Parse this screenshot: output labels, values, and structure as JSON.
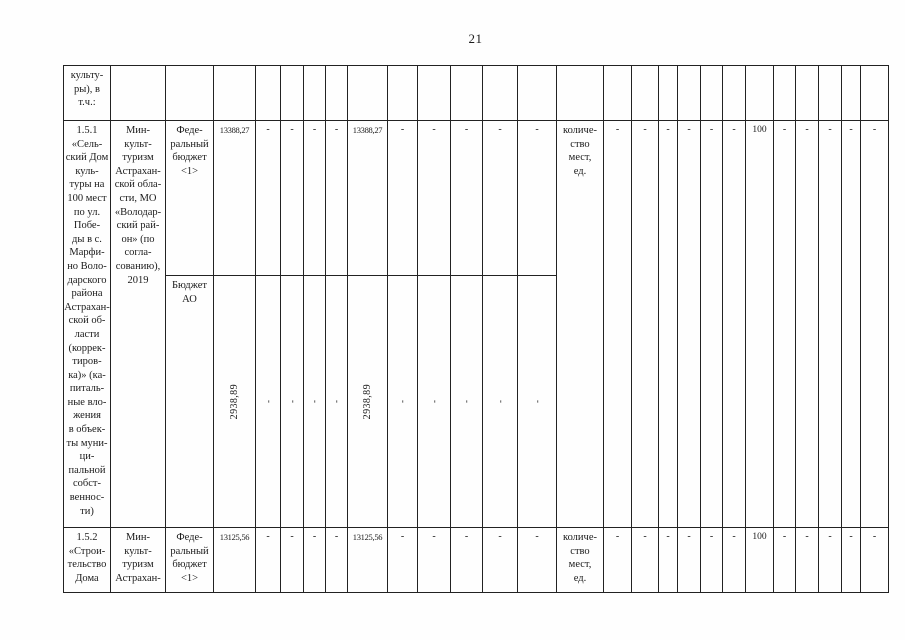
{
  "page_number": "21",
  "table": {
    "cells": [
      {
        "r": 1,
        "c": 1,
        "t": "культу-\nры), в\nт.ч.:",
        "n": "cell-continued-category"
      },
      {
        "r": 2,
        "c": 1,
        "rs": 2,
        "t": "1.5.1\n«Сель-\nский Дом\nкуль-\nтуры на\n100 мест\nпо ул.\nПобе-\nды в с.\nМарфи-\nно Воло-\nдарского\nрайона\nАстрахан-\nской об-\nласти\n(коррек-\nтиров-\nка)» (ка-\nпиталь-\nные вло-\nжения\nв объек-\nты муни-\nци-\nпальной\nсобст-\nвеннос-\nти)",
        "n": "cell-project-1-5-1-name"
      },
      {
        "r": 2,
        "c": 2,
        "rs": 2,
        "t": "Мин-\nкульт-\nтуризм\nАстрахан-\nской обла-\nсти, МО\n«Володар-\nский рай-\nон» (по\nсогла-\nсованию),\n2019",
        "n": "cell-project-1-5-1-executor"
      },
      {
        "r": 2,
        "c": 3,
        "t": "Феде-\nральный\nбюджет\n<1>",
        "n": "cell-budget-federal-1-5-1"
      },
      {
        "r": 2,
        "c": 4,
        "k": "num",
        "t": "13388,27",
        "n": "cell-amount-total-federal"
      },
      {
        "r": 2,
        "c": 5,
        "k": "dash",
        "t": "-",
        "n": "cell-amount-dash"
      },
      {
        "r": 2,
        "c": 6,
        "k": "dash",
        "t": "-",
        "n": "cell-amount-dash"
      },
      {
        "r": 2,
        "c": 7,
        "k": "dash",
        "t": "-",
        "n": "cell-amount-dash"
      },
      {
        "r": 2,
        "c": 8,
        "k": "dash",
        "t": "-",
        "n": "cell-amount-dash"
      },
      {
        "r": 2,
        "c": 9,
        "k": "num",
        "t": "13388,27",
        "n": "cell-amount-year-federal"
      },
      {
        "r": 2,
        "c": 10,
        "k": "dash",
        "t": "-",
        "n": "cell-amount-dash"
      },
      {
        "r": 2,
        "c": 11,
        "k": "dash",
        "t": "-",
        "n": "cell-amount-dash"
      },
      {
        "r": 2,
        "c": 12,
        "k": "dash",
        "t": "-",
        "n": "cell-amount-dash"
      },
      {
        "r": 2,
        "c": 13,
        "k": "dash",
        "t": "-",
        "n": "cell-amount-dash"
      },
      {
        "r": 2,
        "c": 14,
        "k": "dash",
        "t": "-",
        "n": "cell-amount-dash"
      },
      {
        "r": 3,
        "c": 3,
        "t": "Бюджет\nАО",
        "n": "cell-budget-regional-1-5-1"
      },
      {
        "r": 3,
        "c": 4,
        "k": "rot num",
        "t": "2938,89",
        "n": "cell-amount-total-regional"
      },
      {
        "r": 3,
        "c": 5,
        "k": "rot dash",
        "t": "-",
        "n": "cell-amount-dash"
      },
      {
        "r": 3,
        "c": 6,
        "k": "rot dash",
        "t": "-",
        "n": "cell-amount-dash"
      },
      {
        "r": 3,
        "c": 7,
        "k": "rot dash",
        "t": "-",
        "n": "cell-amount-dash"
      },
      {
        "r": 3,
        "c": 8,
        "k": "rot dash",
        "t": "-",
        "n": "cell-amount-dash"
      },
      {
        "r": 3,
        "c": 9,
        "k": "rot num",
        "t": "2938,89",
        "n": "cell-amount-year-regional"
      },
      {
        "r": 3,
        "c": 10,
        "k": "rot dash",
        "t": "-",
        "n": "cell-amount-dash"
      },
      {
        "r": 3,
        "c": 11,
        "k": "rot dash",
        "t": "-",
        "n": "cell-amount-dash"
      },
      {
        "r": 3,
        "c": 12,
        "k": "rot dash",
        "t": "-",
        "n": "cell-amount-dash"
      },
      {
        "r": 3,
        "c": 13,
        "k": "rot dash",
        "t": "-",
        "n": "cell-amount-dash"
      },
      {
        "r": 3,
        "c": 14,
        "k": "rot dash",
        "t": "-",
        "n": "cell-amount-dash"
      },
      {
        "r": 2,
        "c": 15,
        "rs": 2,
        "t": "количе-\nство\nмест,\nед.",
        "n": "cell-indicator-name-1-5-1"
      },
      {
        "r": 2,
        "c": 16,
        "rs": 2,
        "k": "dash",
        "t": "-",
        "n": "cell-indicator-dash"
      },
      {
        "r": 2,
        "c": 17,
        "rs": 2,
        "k": "dash",
        "t": "-",
        "n": "cell-indicator-dash"
      },
      {
        "r": 2,
        "c": 18,
        "rs": 2,
        "k": "dash",
        "t": "-",
        "n": "cell-indicator-dash"
      },
      {
        "r": 2,
        "c": 19,
        "rs": 2,
        "k": "dash",
        "t": "-",
        "n": "cell-indicator-dash"
      },
      {
        "r": 2,
        "c": 20,
        "rs": 2,
        "k": "dash",
        "t": "-",
        "n": "cell-indicator-dash"
      },
      {
        "r": 2,
        "c": 21,
        "rs": 2,
        "k": "dash",
        "t": "-",
        "n": "cell-indicator-dash"
      },
      {
        "r": 2,
        "c": 22,
        "rs": 2,
        "k": "val",
        "t": "100",
        "n": "cell-indicator-value-1-5-1"
      },
      {
        "r": 2,
        "c": 23,
        "rs": 2,
        "k": "dash",
        "t": "-",
        "n": "cell-indicator-dash"
      },
      {
        "r": 2,
        "c": 24,
        "rs": 2,
        "k": "dash",
        "t": "-",
        "n": "cell-indicator-dash"
      },
      {
        "r": 2,
        "c": 25,
        "rs": 2,
        "k": "dash",
        "t": "-",
        "n": "cell-indicator-dash"
      },
      {
        "r": 2,
        "c": 26,
        "rs": 2,
        "k": "dash",
        "t": "-",
        "n": "cell-indicator-dash"
      },
      {
        "r": 2,
        "c": 27,
        "rs": 2,
        "k": "dash",
        "t": "-",
        "n": "cell-indicator-dash"
      },
      {
        "r": 4,
        "c": 1,
        "t": "1.5.2\n«Строи-\nтельство\nДома",
        "n": "cell-project-1-5-2-name"
      },
      {
        "r": 4,
        "c": 2,
        "t": "Мин-\nкульт-\nтуризм\nАстрахан-",
        "n": "cell-project-1-5-2-executor"
      },
      {
        "r": 4,
        "c": 3,
        "t": "Феде-\nральный\nбюджет\n<1>",
        "n": "cell-budget-federal-1-5-2"
      },
      {
        "r": 4,
        "c": 4,
        "k": "num",
        "t": "13125,56",
        "n": "cell-amount-total-federal"
      },
      {
        "r": 4,
        "c": 5,
        "k": "dash",
        "t": "-",
        "n": "cell-amount-dash"
      },
      {
        "r": 4,
        "c": 6,
        "k": "dash",
        "t": "-",
        "n": "cell-amount-dash"
      },
      {
        "r": 4,
        "c": 7,
        "k": "dash",
        "t": "-",
        "n": "cell-amount-dash"
      },
      {
        "r": 4,
        "c": 8,
        "k": "dash",
        "t": "-",
        "n": "cell-amount-dash"
      },
      {
        "r": 4,
        "c": 9,
        "k": "num",
        "t": "13125,56",
        "n": "cell-amount-year-federal"
      },
      {
        "r": 4,
        "c": 10,
        "k": "dash",
        "t": "-",
        "n": "cell-amount-dash"
      },
      {
        "r": 4,
        "c": 11,
        "k": "dash",
        "t": "-",
        "n": "cell-amount-dash"
      },
      {
        "r": 4,
        "c": 12,
        "k": "dash",
        "t": "-",
        "n": "cell-amount-dash"
      },
      {
        "r": 4,
        "c": 13,
        "k": "dash",
        "t": "-",
        "n": "cell-amount-dash"
      },
      {
        "r": 4,
        "c": 14,
        "k": "dash",
        "t": "-",
        "n": "cell-amount-dash"
      },
      {
        "r": 4,
        "c": 15,
        "t": "количе-\nство\nмест,\nед.",
        "n": "cell-indicator-name-1-5-2"
      },
      {
        "r": 4,
        "c": 16,
        "k": "dash",
        "t": "-",
        "n": "cell-indicator-dash"
      },
      {
        "r": 4,
        "c": 17,
        "k": "dash",
        "t": "-",
        "n": "cell-indicator-dash"
      },
      {
        "r": 4,
        "c": 18,
        "k": "dash",
        "t": "-",
        "n": "cell-indicator-dash"
      },
      {
        "r": 4,
        "c": 19,
        "k": "dash",
        "t": "-",
        "n": "cell-indicator-dash"
      },
      {
        "r": 4,
        "c": 20,
        "k": "dash",
        "t": "-",
        "n": "cell-indicator-dash"
      },
      {
        "r": 4,
        "c": 21,
        "k": "dash",
        "t": "-",
        "n": "cell-indicator-dash"
      },
      {
        "r": 4,
        "c": 22,
        "k": "val",
        "t": "100",
        "n": "cell-indicator-value-1-5-2"
      },
      {
        "r": 4,
        "c": 23,
        "k": "dash",
        "t": "-",
        "n": "cell-indicator-dash"
      },
      {
        "r": 4,
        "c": 24,
        "k": "dash",
        "t": "-",
        "n": "cell-indicator-dash"
      },
      {
        "r": 4,
        "c": 25,
        "k": "dash",
        "t": "-",
        "n": "cell-indicator-dash"
      },
      {
        "r": 4,
        "c": 26,
        "k": "dash",
        "t": "-",
        "n": "cell-indicator-dash"
      },
      {
        "r": 4,
        "c": 27,
        "k": "dash",
        "t": "-",
        "n": "cell-indicator-dash"
      }
    ]
  }
}
